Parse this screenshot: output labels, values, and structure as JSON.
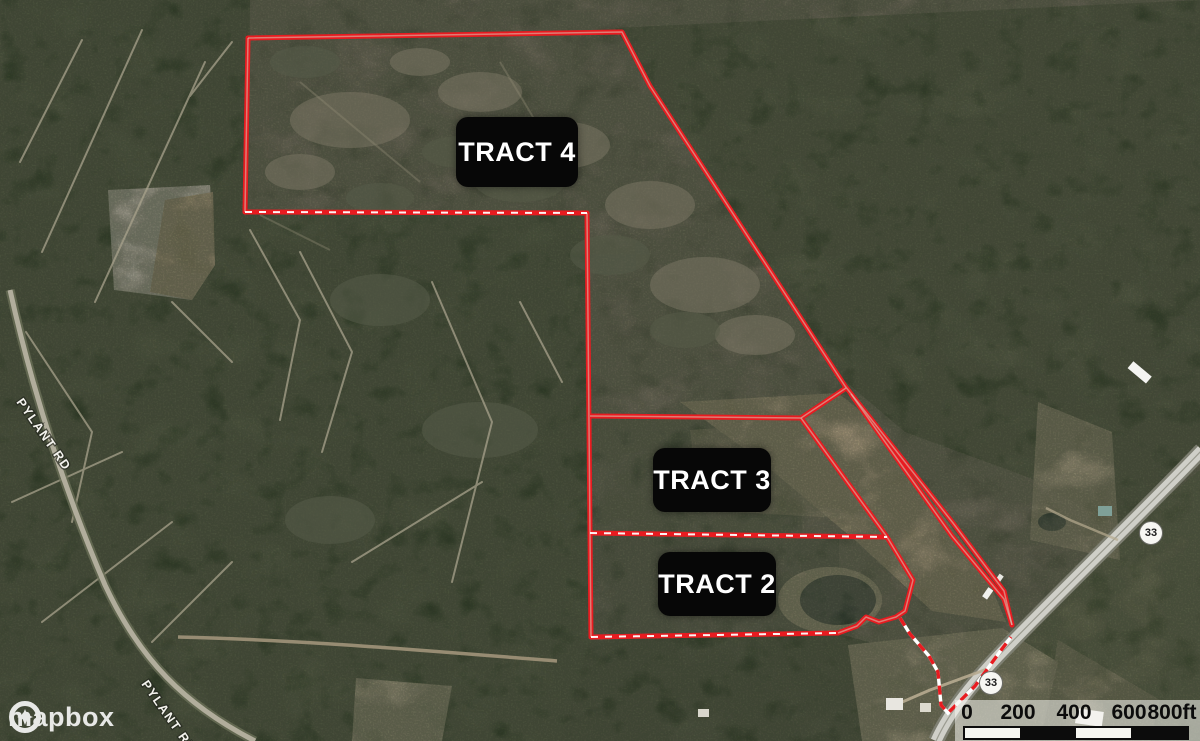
{
  "tracts": [
    {
      "label": "TRACT 4"
    },
    {
      "label": "TRACT 3"
    },
    {
      "label": "TRACT 2"
    }
  ],
  "roads": {
    "pylant_upper": "PYLANT RD",
    "pylant_lower": "PYLANT RD",
    "route_shield_upper": "33",
    "route_shield_lower": "33"
  },
  "scale_bar": {
    "tick_labels": [
      "0",
      "200",
      "400",
      "600"
    ],
    "end_label": "800ft"
  },
  "attribution": {
    "wordmark": "mapbox"
  },
  "colors": {
    "boundary": "#e81b20",
    "tract_label_bg": "#070707",
    "tract_label_text": "#ffffff",
    "scale_text": "#0c0c0c"
  }
}
